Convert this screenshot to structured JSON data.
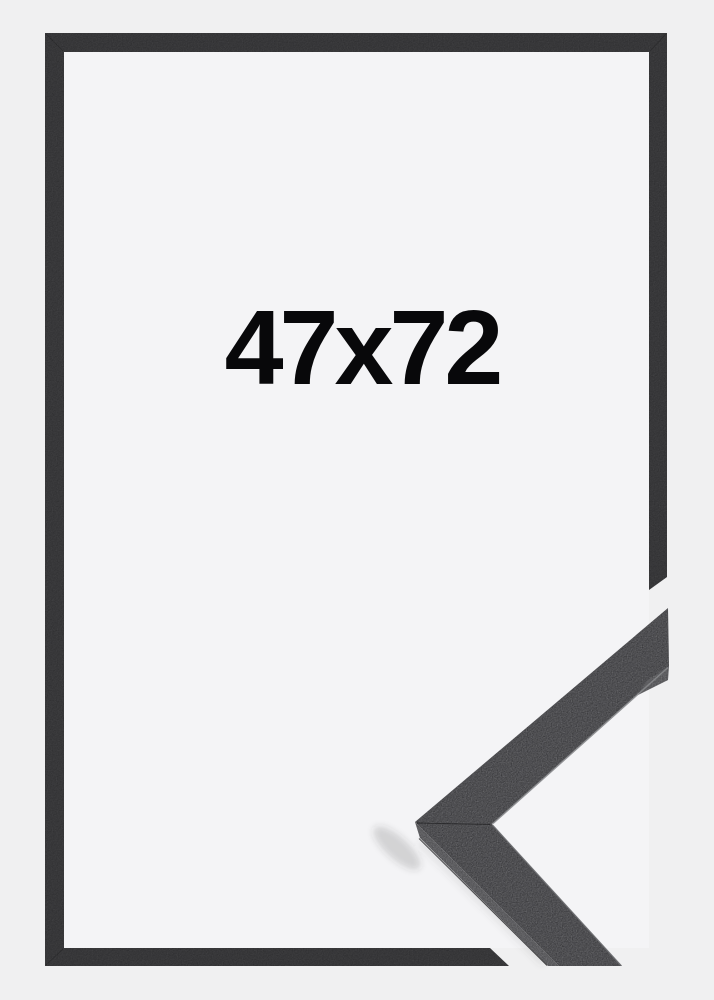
{
  "product": {
    "size_label": "47x72"
  },
  "colors": {
    "background": "#f0f0f1",
    "paper": "#f4f4f6",
    "frame": "#303032",
    "sample_face": "#3a3a3d",
    "sample_bevel": "#4c4c4f",
    "sample_end_bevel": "#4b4b4e",
    "edge_highlight": "#87888b",
    "text": "#08080a"
  }
}
